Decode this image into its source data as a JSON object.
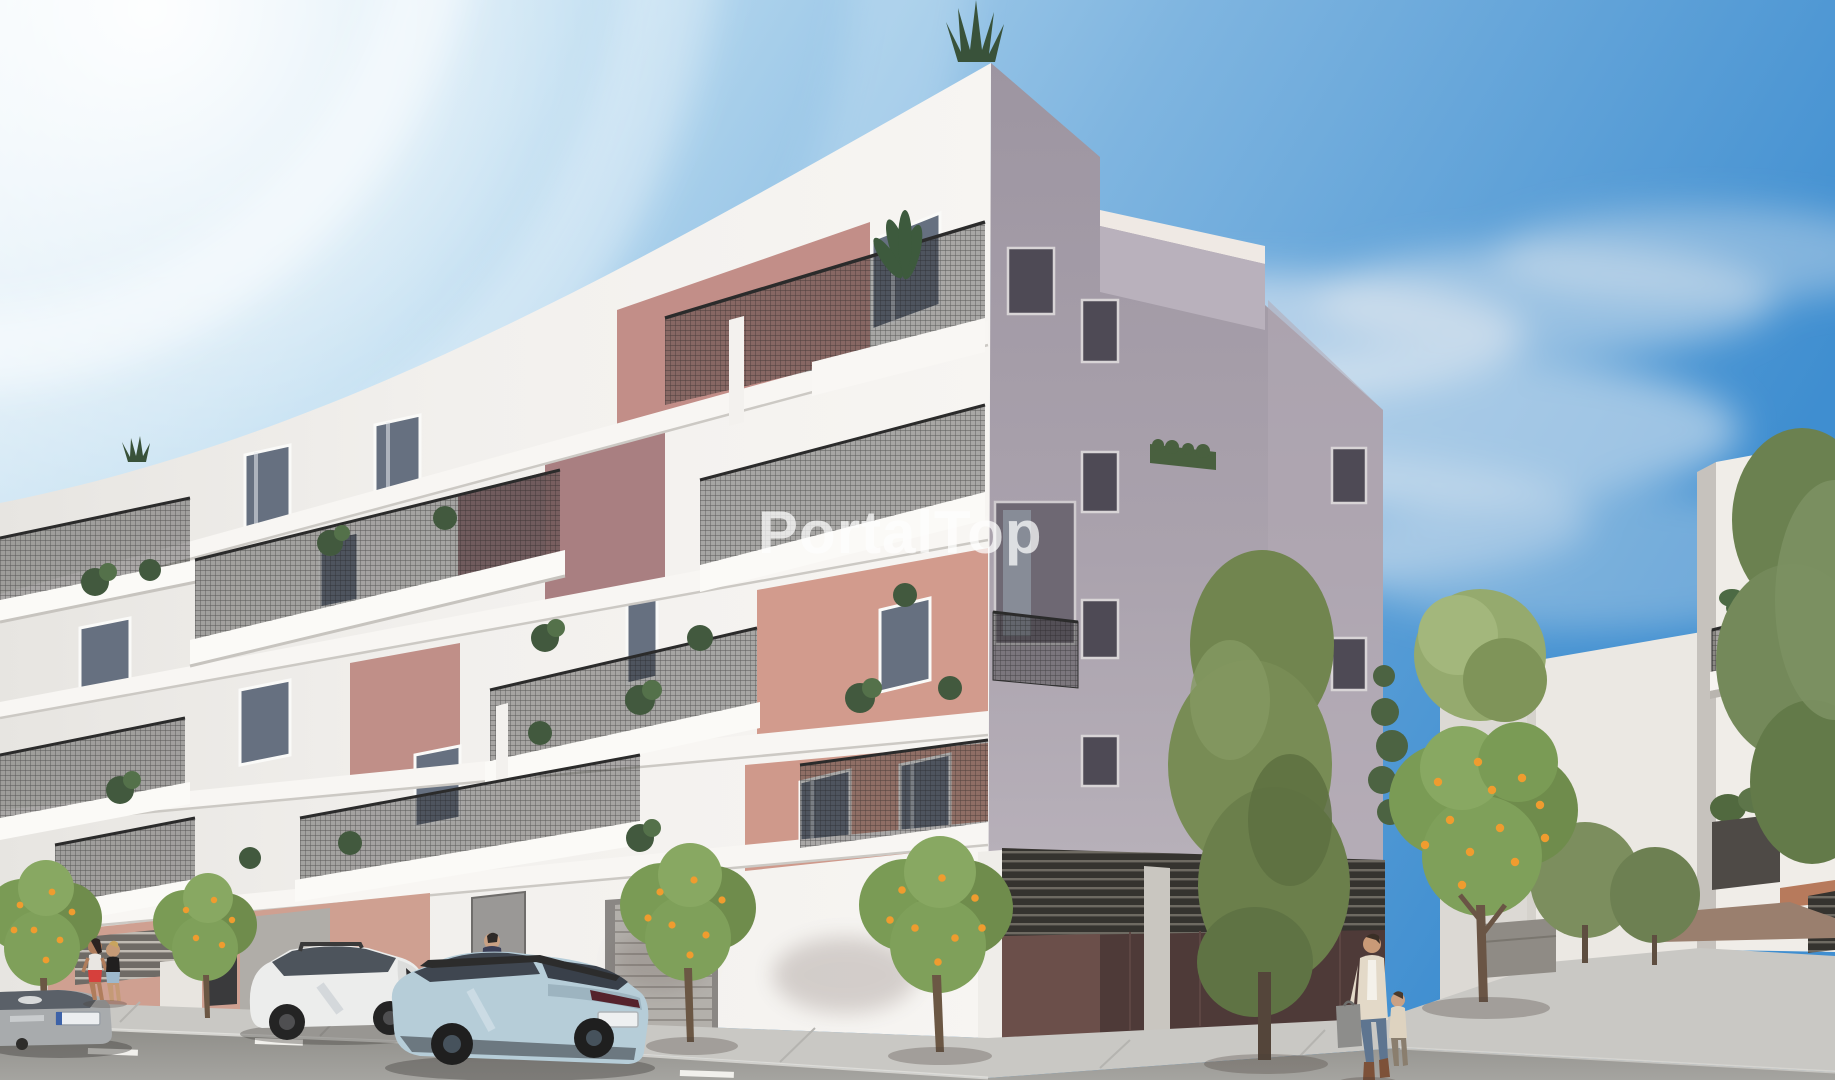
{
  "watermark": {
    "text": "PortalTop",
    "color": "#ffffff",
    "opacity": 0.72
  },
  "scene": {
    "type": "architectural-render",
    "subject": "New-build five-storey corner apartment block with staggered white balconies, dark mesh railings and salmon accent walls; street with parked cars, orange trees and pedestrians under a blue sky",
    "palette": {
      "sky_deep": "#3f8ed0",
      "sky_light": "#e9f3f9",
      "cloud": "#e8edf2",
      "facade_sunlit": "#f4f2ef",
      "facade_shadow": "#a8a1ac",
      "accent_salmon": "#d29b8d",
      "accent_salmon_shadow": "#9b7a80",
      "railing_dark": "#3a3a3a",
      "garage_maroon": "#4e3a38",
      "louvre_dark": "#35332f",
      "road": "#96958f",
      "sidewalk": "#c9c8c4",
      "tree_green": "#768c52",
      "orange_fruit": "#ef9c2f",
      "car_white": "#ecedec",
      "car_blue": "#b6cdd8",
      "car_silver": "#a8abad"
    },
    "objects": [
      "sky",
      "sun-glow",
      "clouds",
      "main-building-front-facade",
      "main-building-side-facade",
      "rooftop-agave-plant",
      "roof-terrace-railing",
      "balconies",
      "balcony-plants",
      "salmon-accent-walls",
      "garage-level",
      "garage-doors",
      "louvre-grilles",
      "background-building",
      "right-apartment-building",
      "orange-trees",
      "tall-green-tree",
      "street-trees",
      "sidewalk",
      "road",
      "lane-markings",
      "silver-hatchback",
      "white-suv",
      "blue-crossover",
      "jogging-women",
      "man-pedestrian",
      "woman-with-shopping-bags",
      "child-pedestrian"
    ]
  }
}
